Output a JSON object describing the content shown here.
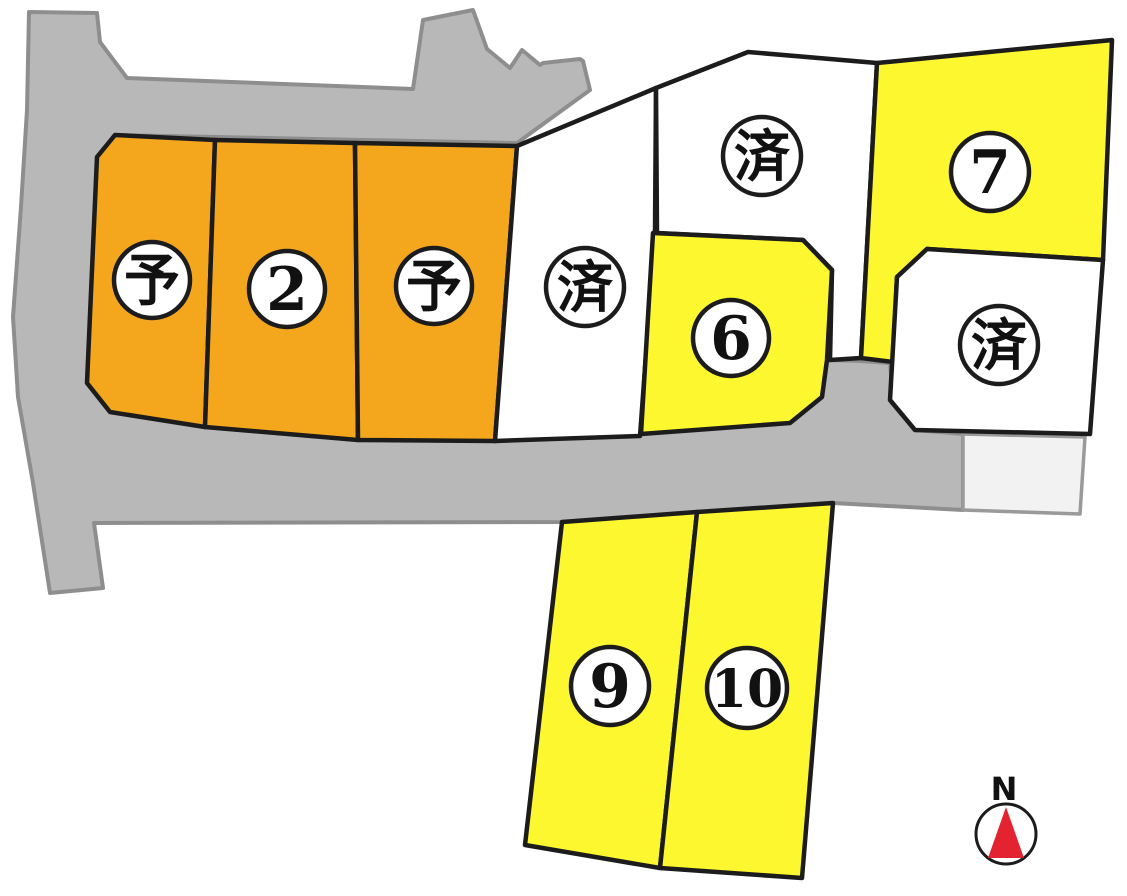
{
  "map_title": "lot-subdivision-plan",
  "colors": {
    "background": "#ffffff",
    "road_fill": "#b8b8b8",
    "road_stroke": "#8e8e8e",
    "reserved_orange": "#f4a71d",
    "available_yellow": "#fcf72e",
    "sold_white": "#ffffff",
    "other_parcel_fill": "#f2f2f2",
    "lot_border": "#1c1c1c",
    "badge_fill": "#ffffff",
    "compass_needle": "#e32430"
  },
  "road": {
    "fill": "#b8b8b8"
  },
  "other_parcel": {
    "fill": "#f2f2f2"
  },
  "lots": [
    {
      "id": "lot-1",
      "label": "予",
      "kind": "kanji",
      "fill": "#f4a71d"
    },
    {
      "id": "lot-2",
      "label": "2",
      "kind": "number",
      "fill": "#f4a71d"
    },
    {
      "id": "lot-3",
      "label": "予",
      "kind": "kanji",
      "fill": "#f4a71d"
    },
    {
      "id": "lot-4",
      "label": "済",
      "kind": "kanji",
      "fill": "#ffffff"
    },
    {
      "id": "lot-5",
      "label": "済",
      "kind": "kanji",
      "fill": "#ffffff"
    },
    {
      "id": "lot-6",
      "label": "6",
      "kind": "number",
      "fill": "#fcf72e"
    },
    {
      "id": "lot-7",
      "label": "7",
      "kind": "number",
      "fill": "#fcf72e"
    },
    {
      "id": "lot-8",
      "label": "済",
      "kind": "kanji",
      "fill": "#ffffff"
    },
    {
      "id": "lot-9",
      "label": "9",
      "kind": "number",
      "fill": "#fcf72e"
    },
    {
      "id": "lot-10",
      "label": "10",
      "kind": "number",
      "fill": "#fcf72e"
    }
  ],
  "compass": {
    "label": "N",
    "needle_color": "#e32430"
  }
}
